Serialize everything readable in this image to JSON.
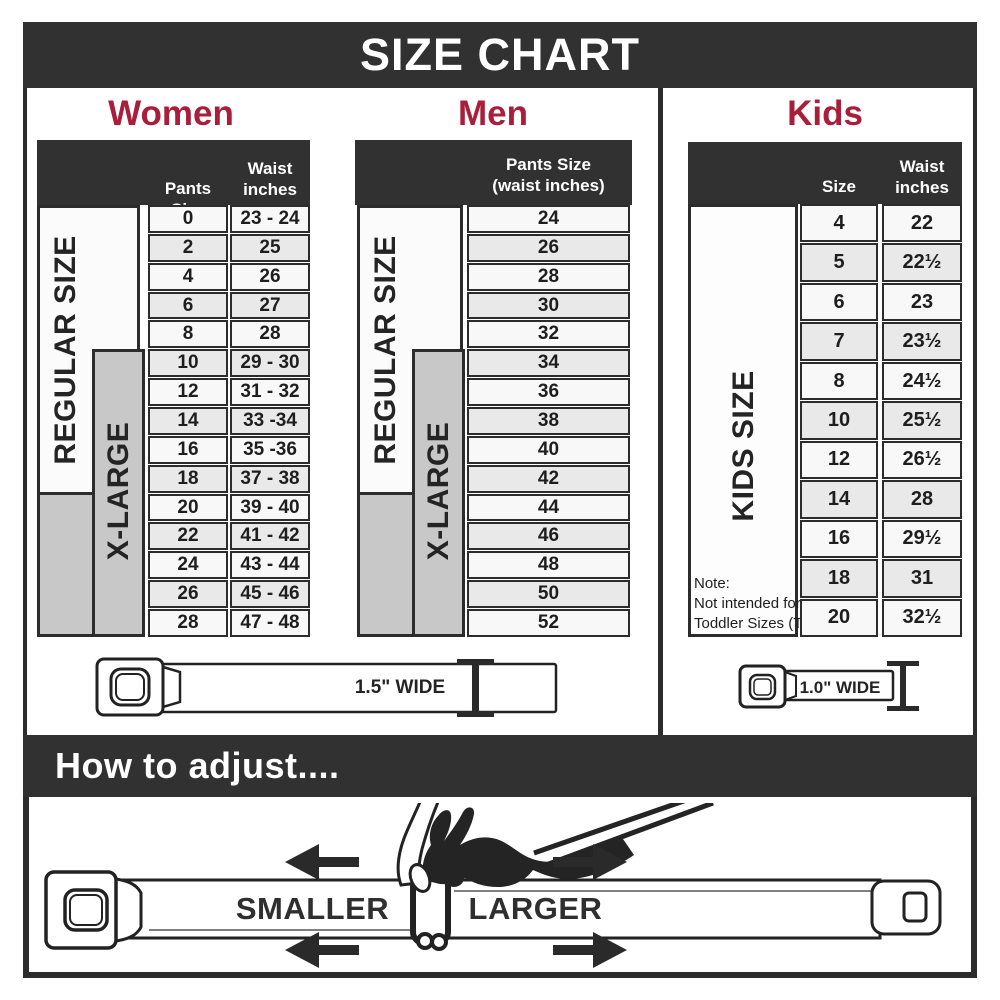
{
  "title": "SIZE CHART",
  "colors": {
    "accent_red": "#A81E3B",
    "charcoal": "#323132",
    "xlarge_gray": "#C8C8C8"
  },
  "chart_data": [
    {
      "type": "table",
      "title": "Women",
      "columns": [
        "Pants Size",
        "Waist inches"
      ],
      "rows": [
        [
          "0",
          "23 - 24"
        ],
        [
          "2",
          "25"
        ],
        [
          "4",
          "26"
        ],
        [
          "6",
          "27"
        ],
        [
          "8",
          "28"
        ],
        [
          "10",
          "29 - 30"
        ],
        [
          "12",
          "31 - 32"
        ],
        [
          "14",
          "33 -34"
        ],
        [
          "16",
          "35 -36"
        ],
        [
          "18",
          "37 - 38"
        ],
        [
          "20",
          "39 - 40"
        ],
        [
          "22",
          "41 - 42"
        ],
        [
          "24",
          "43 - 44"
        ],
        [
          "26",
          "45 - 46"
        ],
        [
          "28",
          "47 - 48"
        ]
      ],
      "groups": [
        {
          "label": "REGULAR SIZE",
          "row_range": "sizes 0-18"
        },
        {
          "label": "X-LARGE",
          "row_range": "sizes 10-28"
        }
      ]
    },
    {
      "type": "table",
      "title": "Men",
      "columns": [
        "Pants Size (waist inches)"
      ],
      "rows": [
        [
          "24"
        ],
        [
          "26"
        ],
        [
          "28"
        ],
        [
          "30"
        ],
        [
          "32"
        ],
        [
          "34"
        ],
        [
          "36"
        ],
        [
          "38"
        ],
        [
          "40"
        ],
        [
          "42"
        ],
        [
          "44"
        ],
        [
          "46"
        ],
        [
          "48"
        ],
        [
          "50"
        ],
        [
          "52"
        ]
      ],
      "groups": [
        {
          "label": "REGULAR SIZE",
          "row_range": "sizes 24-36"
        },
        {
          "label": "X-LARGE",
          "row_range": "sizes 34-52"
        }
      ]
    },
    {
      "type": "table",
      "title": "Kids",
      "columns": [
        "Size",
        "Waist inches"
      ],
      "rows": [
        [
          "4",
          "22"
        ],
        [
          "5",
          "22½"
        ],
        [
          "6",
          "23"
        ],
        [
          "7",
          "23½"
        ],
        [
          "8",
          "24½"
        ],
        [
          "10",
          "25½"
        ],
        [
          "12",
          "26½"
        ],
        [
          "14",
          "28"
        ],
        [
          "16",
          "29½"
        ],
        [
          "18",
          "31"
        ],
        [
          "20",
          "32½"
        ]
      ],
      "groups": [
        {
          "label": "KIDS SIZE",
          "row_range": "sizes 4-20"
        }
      ],
      "note": "Note: Not intended for Toddler Sizes (T)"
    }
  ],
  "labels": {
    "women_col1": "Pants Size",
    "women_col2a": "Waist",
    "women_col2b": "inches",
    "men_col1a": "Pants Size",
    "men_col1b": "(waist inches)",
    "kids_col1": "Size",
    "kids_col2a": "Waist",
    "kids_col2b": "inches",
    "regular": "REGULAR SIZE",
    "xlarge": "X-LARGE",
    "kids_side": "KIDS SIZE",
    "note1": "Note:",
    "note2": "Not intended for",
    "note3": "Toddler Sizes (T)",
    "adult_belt_width": "1.5\" WIDE",
    "kids_belt_width": "1.0\" WIDE",
    "adjust_heading": "How to adjust....",
    "smaller": "SMALLER",
    "larger": "LARGER"
  }
}
